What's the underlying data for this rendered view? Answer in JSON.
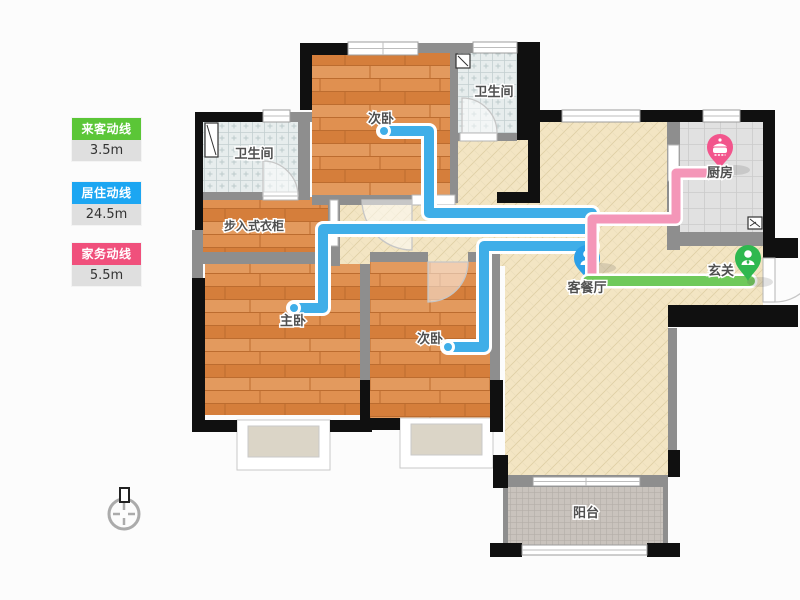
{
  "legend": {
    "items": [
      {
        "label": "来客动线",
        "value": "3.5m",
        "color": "#5BC637"
      },
      {
        "label": "居住动线",
        "value": "24.5m",
        "color": "#1CA6F2"
      },
      {
        "label": "家务动线",
        "value": "5.5m",
        "color": "#F0507C"
      }
    ]
  },
  "rooms": {
    "bath_left": "卫生间",
    "bedroom_top": "次卧",
    "bath_top": "卫生间",
    "closet": "步入式衣柜",
    "master_bedroom": "主卧",
    "bedroom_bottom": "次卧",
    "living_dining": "客餐厅",
    "kitchen": "厨房",
    "entry": "玄关",
    "balcony": "阳台"
  },
  "paths": {
    "guest_line": {
      "name": "来客动线",
      "color": "#6FC95A"
    },
    "living_line": {
      "name": "居住动线",
      "color": "#3FAEE8"
    },
    "chore_line": {
      "name": "家务动线",
      "color": "#F287AE"
    }
  },
  "pins": {
    "living": "living-room-pin",
    "kitchen": "kitchen-pot-pin",
    "entry": "entry-person-pin"
  }
}
